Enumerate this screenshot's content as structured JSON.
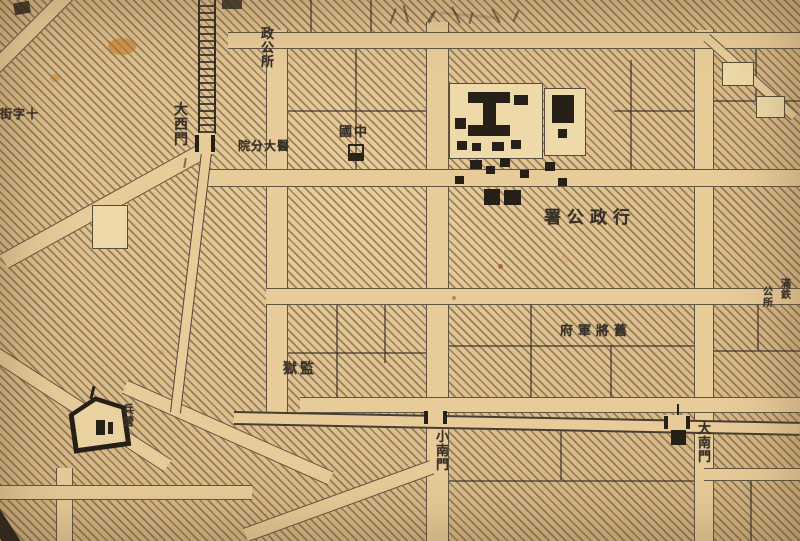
{
  "map": {
    "description": "aged hand-drawn city map with hatched blocks, city wall and gates",
    "palette": {
      "paper": "#e4c38e",
      "road": "#e7cb99",
      "ink": "#372f26",
      "building_black": "#262019",
      "courtyard": "#eed9a9",
      "stain_orange": "#c0741c",
      "stain_red": "#a83a22"
    },
    "labels": [
      {
        "name": "label-gate-daximen",
        "text": "大西門",
        "orientation": "vertical",
        "x": 174,
        "y": 103,
        "size": 14,
        "spacing": 0
      },
      {
        "name": "label-zhenggongsuo",
        "text": "政公所",
        "orientation": "vertical",
        "x": 261,
        "y": 28,
        "size": 13,
        "spacing": 0
      },
      {
        "name": "label-medical-branch",
        "text": "院分大醫",
        "orientation": "horizontal",
        "x": 238,
        "y": 140,
        "size": 12,
        "spacing": 1
      },
      {
        "name": "label-zhongguo",
        "text": "國中",
        "orientation": "horizontal",
        "x": 339,
        "y": 126,
        "size": 13,
        "spacing": 2
      },
      {
        "name": "label-admin-office",
        "text": "署公政行",
        "orientation": "horizontal",
        "x": 544,
        "y": 209,
        "size": 17,
        "spacing": 6
      },
      {
        "name": "label-old-general-residence",
        "text": "府軍將舊",
        "orientation": "horizontal",
        "x": 560,
        "y": 325,
        "size": 13,
        "spacing": 5
      },
      {
        "name": "label-prison",
        "text": "獄監",
        "orientation": "horizontal",
        "x": 283,
        "y": 362,
        "size": 14,
        "spacing": 3
      },
      {
        "name": "label-gate-xiaonanmen",
        "text": "小南門",
        "orientation": "vertical",
        "x": 436,
        "y": 431,
        "size": 13,
        "spacing": 0
      },
      {
        "name": "label-gate-dananmen",
        "text": "大南門",
        "orientation": "vertical",
        "x": 698,
        "y": 423,
        "size": 13,
        "spacing": 0
      },
      {
        "name": "label-barracks",
        "text": "兵營",
        "orientation": "vertical",
        "x": 123,
        "y": 404,
        "size": 11,
        "spacing": 0
      },
      {
        "name": "label-cross-street",
        "text": "街字十",
        "orientation": "horizontal",
        "x": 0,
        "y": 108,
        "size": 12,
        "spacing": 1
      },
      {
        "name": "label-mantetsu-office-right",
        "text": "滿鉄",
        "orientation": "vertical",
        "x": 781,
        "y": 280,
        "size": 10,
        "spacing": 0
      },
      {
        "name": "label-mantetsu-office-left",
        "text": "公所",
        "orientation": "vertical",
        "x": 763,
        "y": 288,
        "size": 10,
        "spacing": 0
      }
    ],
    "structures": [
      {
        "name": "government-compound-courtyard",
        "type": "courtyard",
        "x": 449,
        "y": 83,
        "w": 92,
        "h": 74
      },
      {
        "name": "government-compound-courtyard-east",
        "type": "courtyard",
        "x": 544,
        "y": 88,
        "w": 40,
        "h": 66
      },
      {
        "name": "small-courtyard-northeast-1",
        "type": "courtyard",
        "x": 722,
        "y": 62,
        "w": 30,
        "h": 22
      },
      {
        "name": "small-courtyard-northeast-2",
        "type": "courtyard",
        "x": 756,
        "y": 96,
        "w": 27,
        "h": 20
      },
      {
        "name": "small-courtyard-west",
        "type": "courtyard",
        "x": 92,
        "y": 205,
        "w": 34,
        "h": 42
      },
      {
        "name": "main-hall-building",
        "type": "building",
        "x": 468,
        "y": 92,
        "w": 42,
        "h": 11
      },
      {
        "name": "main-hall-building",
        "type": "building",
        "x": 483,
        "y": 101,
        "w": 13,
        "h": 26
      },
      {
        "name": "main-hall-building",
        "type": "building",
        "x": 468,
        "y": 125,
        "w": 42,
        "h": 11
      },
      {
        "name": "compound-building",
        "type": "building",
        "x": 455,
        "y": 118,
        "w": 11,
        "h": 11
      },
      {
        "name": "compound-building",
        "type": "building",
        "x": 514,
        "y": 95,
        "w": 14,
        "h": 10
      },
      {
        "name": "compound-building",
        "type": "building",
        "x": 457,
        "y": 141,
        "w": 10,
        "h": 9
      },
      {
        "name": "compound-building",
        "type": "building",
        "x": 472,
        "y": 143,
        "w": 9,
        "h": 8
      },
      {
        "name": "compound-building",
        "type": "building",
        "x": 492,
        "y": 142,
        "w": 12,
        "h": 9
      },
      {
        "name": "compound-building",
        "type": "building",
        "x": 511,
        "y": 140,
        "w": 10,
        "h": 9
      },
      {
        "name": "east-hall-building",
        "type": "building",
        "x": 552,
        "y": 95,
        "w": 22,
        "h": 28
      },
      {
        "name": "east-hall-annex",
        "type": "building",
        "x": 558,
        "y": 129,
        "w": 9,
        "h": 9
      },
      {
        "name": "small-building",
        "type": "building",
        "x": 470,
        "y": 160,
        "w": 12,
        "h": 9
      },
      {
        "name": "small-building",
        "type": "building",
        "x": 486,
        "y": 166,
        "w": 9,
        "h": 8
      },
      {
        "name": "small-building",
        "type": "building",
        "x": 500,
        "y": 158,
        "w": 10,
        "h": 9
      },
      {
        "name": "small-building",
        "type": "building",
        "x": 455,
        "y": 176,
        "w": 9,
        "h": 8
      },
      {
        "name": "small-building",
        "type": "building",
        "x": 520,
        "y": 170,
        "w": 9,
        "h": 8
      },
      {
        "name": "small-building",
        "type": "building",
        "x": 545,
        "y": 162,
        "w": 10,
        "h": 9
      },
      {
        "name": "small-building",
        "type": "building",
        "x": 558,
        "y": 178,
        "w": 9,
        "h": 8
      },
      {
        "name": "admin-office-building",
        "type": "building",
        "x": 484,
        "y": 189,
        "w": 16,
        "h": 16
      },
      {
        "name": "admin-office-building",
        "type": "building",
        "x": 504,
        "y": 190,
        "w": 17,
        "h": 15
      },
      {
        "name": "west-gate-opening",
        "type": "gate",
        "x": 195,
        "y": 133,
        "w": 20,
        "h": 21
      },
      {
        "name": "small-south-gate-opening",
        "type": "gate",
        "x": 424,
        "y": 410,
        "w": 23,
        "h": 15
      },
      {
        "name": "great-south-gate-opening",
        "type": "gate",
        "x": 664,
        "y": 415,
        "w": 26,
        "h": 15
      },
      {
        "name": "great-south-gate-tower",
        "type": "building",
        "x": 671,
        "y": 428,
        "w": 15,
        "h": 17
      },
      {
        "name": "great-south-gate-flagpole",
        "type": "pole",
        "x": 677,
        "y": 404,
        "w": 2,
        "h": 26
      },
      {
        "name": "barracks-inner-building",
        "type": "building",
        "x": 96,
        "y": 420,
        "w": 9,
        "h": 15
      },
      {
        "name": "barracks-inner-building",
        "type": "building",
        "x": 108,
        "y": 422,
        "w": 5,
        "h": 12
      }
    ]
  }
}
